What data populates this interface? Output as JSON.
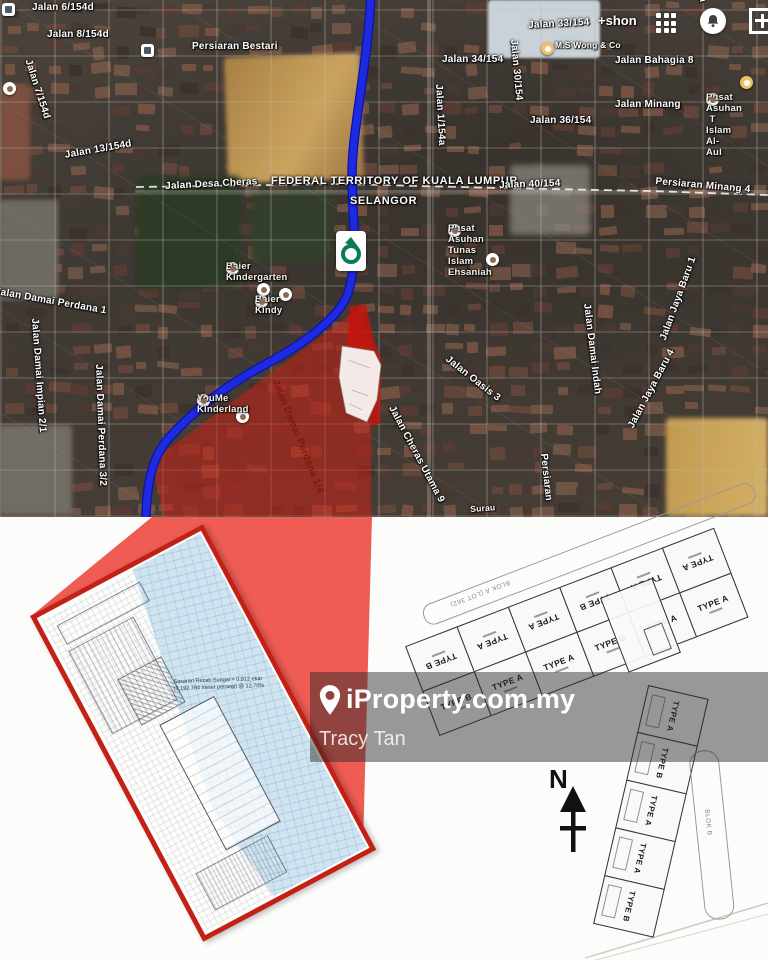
{
  "map": {
    "account_label": "+shon",
    "boundary_label": "FEDERAL TERRITORY OF KUALA LUMPUR",
    "state_label": "SELANGOR",
    "labels": [
      {
        "n": "jalan-6-154d",
        "t": "Jalan 6/154d",
        "x": 32,
        "y": 2,
        "r": 0
      },
      {
        "n": "jalan-8-154d",
        "t": "Jalan 8/154d",
        "x": 47,
        "y": 29,
        "r": 0
      },
      {
        "n": "jalan-7-154d",
        "t": "Jalan 7/154d",
        "x": 33,
        "y": 58,
        "r": 72
      },
      {
        "n": "jalan-13-154d",
        "t": "Jalan 13/154d",
        "x": 64,
        "y": 150,
        "r": -10
      },
      {
        "n": "persiaran-bestari",
        "t": "Persiaran Bestari",
        "x": 192,
        "y": 41,
        "r": 0
      },
      {
        "n": "jalan-desa-cheras",
        "t": "Jalan Desa Cheras",
        "x": 165,
        "y": 181,
        "r": -3
      },
      {
        "n": "federal-territory",
        "t": "FEDERAL TERRITORY OF KUALA LUMPUR",
        "x": 271,
        "y": 175,
        "r": 0,
        "s": "bold"
      },
      {
        "n": "selangor",
        "t": "SELANGOR",
        "x": 350,
        "y": 195,
        "r": 0,
        "s": "bold"
      },
      {
        "n": "jalan-33-154",
        "t": "Jalan 33/154",
        "x": 528,
        "y": 20,
        "r": -3
      },
      {
        "n": "jalan-34-154",
        "t": "Jalan 34/154",
        "x": 442,
        "y": 54,
        "r": 0
      },
      {
        "n": "jalan-30-154",
        "t": "Jalan 30/154",
        "x": 519,
        "y": 39,
        "r": 85
      },
      {
        "n": "jalan-bahagia-8",
        "t": "Jalan Bahagia 8",
        "x": 615,
        "y": 55,
        "r": 0
      },
      {
        "n": "jalan-bahagia-11",
        "t": "Jalan Bahagia 11",
        "x": 716,
        "y": -40,
        "r": 84
      },
      {
        "n": "jalan-minang",
        "t": "Jalan Minang",
        "x": 615,
        "y": 99,
        "r": 0
      },
      {
        "n": "jalan-36-154",
        "t": "Jalan 36/154",
        "x": 530,
        "y": 115,
        "r": 0
      },
      {
        "n": "jalan-1-154a",
        "t": "Jalan 1/154a",
        "x": 444,
        "y": 84,
        "r": 87
      },
      {
        "n": "jalan-40-154",
        "t": "Jalan 40/154",
        "x": 499,
        "y": 180,
        "r": -2
      },
      {
        "n": "persiaran-minang-4",
        "t": "Persiaran Minang 4",
        "x": 656,
        "y": 176,
        "r": 5
      },
      {
        "n": "ms-wong-co",
        "t": "M.S Wong & Co",
        "x": 555,
        "y": 41,
        "r": 0,
        "s": "poi-sm"
      },
      {
        "n": "pusat-asuhan-al-aul",
        "t": "Pusat Asuhan T\nIslam Al- Aul",
        "x": 706,
        "y": 93,
        "r": 0,
        "s": "poi"
      },
      {
        "n": "pusat-asuhan-tunas",
        "t": "Pusat Asuhan Tunas\nIslam Ehsaniah",
        "x": 448,
        "y": 224,
        "r": 0,
        "s": "poi"
      },
      {
        "n": "baier-kindergarten",
        "t": "Baier Kindergarten",
        "x": 226,
        "y": 262,
        "r": 0,
        "s": "poi"
      },
      {
        "n": "baier-kindy",
        "t": "Baier Kindy",
        "x": 255,
        "y": 295,
        "r": 0,
        "s": "poi"
      },
      {
        "n": "jalan-damai-perdana-1",
        "t": "Jalan Damai Perdana 1",
        "x": -4,
        "y": 286,
        "r": 10
      },
      {
        "n": "jalan-damai-impian-2-1",
        "t": "Jalan Damai Impian 2/1",
        "x": 40,
        "y": 318,
        "r": 86
      },
      {
        "n": "jalan-damai-perdana-3-2",
        "t": "Jalan Damai Perdana 3/2",
        "x": 104,
        "y": 364,
        "r": 88
      },
      {
        "n": "youme-kinderland",
        "t": "YouMe Kinderland",
        "x": 197,
        "y": 394,
        "r": 0,
        "s": "poi"
      },
      {
        "n": "jalan-damai-perdana-1-4",
        "t": "Jalan Damai Perdana 1/4",
        "x": 280,
        "y": 378,
        "r": 68,
        "s": "red"
      },
      {
        "n": "jalan-oasis-3",
        "t": "Jalan Oasis 3",
        "x": 450,
        "y": 354,
        "r": 38
      },
      {
        "n": "jalan-cheras-utama-9",
        "t": "Jalan Cheras Utama 9",
        "x": 396,
        "y": 404,
        "r": 62
      },
      {
        "n": "jalan-damai-indah",
        "t": "Jalan Damai Indah",
        "x": 592,
        "y": 303,
        "r": 83
      },
      {
        "n": "jalan-jaya-baru-4",
        "t": "Jalan Jaya Baru 4",
        "x": 626,
        "y": 425,
        "r": -62
      },
      {
        "n": "jalan-jaya-baru-1",
        "t": "Jalan Jaya Baru 1",
        "x": 658,
        "y": 338,
        "r": -70
      },
      {
        "n": "persiaran",
        "t": "Persiaran",
        "x": 549,
        "y": 453,
        "r": 84
      },
      {
        "n": "surau",
        "t": "Surau",
        "x": 470,
        "y": 505,
        "r": -4,
        "s": "poi-sm"
      }
    ],
    "poi_markers": [
      {
        "x": 257,
        "y": 283
      },
      {
        "x": 279,
        "y": 288
      },
      {
        "x": 236,
        "y": 410
      },
      {
        "x": 486,
        "y": 253
      },
      {
        "x": 541,
        "y": 42,
        "tan": 1
      },
      {
        "x": 740,
        "y": 76,
        "tan": 1
      },
      {
        "x": 3,
        "y": 82
      }
    ],
    "colors": {
      "overlay_red": "#d81c10",
      "route_blue": "#1e2ae0",
      "wedge_red": "#ee5c54",
      "inset_border": "#c42116",
      "water_blue": "#cfe4f0"
    }
  },
  "watermark": {
    "brand": "iProperty.com.my",
    "agent": "Tracy Tan"
  },
  "inset": {
    "note_line1": "Sasaran Rezab Sungai = 0.912 ekar",
    "note_line2": "(3,192.784 meter persegi) @ 12.70%"
  },
  "blocks": {
    "north_label": "N",
    "block_a": {
      "road_label": "BLOK A (LOT 362)",
      "top_row": [
        "TYPE B",
        "TYPE A",
        "TYPE A",
        "TYPE B",
        "TYPE A",
        "TYPE A"
      ],
      "bottom_row": [
        "TYPE B",
        "TYPE A",
        "TYPE A",
        "TYPE B",
        "TYPE A",
        "TYPE A"
      ]
    },
    "block_b": {
      "road_label": "BLOK B",
      "units": [
        "TYPE A",
        "TYPE B",
        "TYPE A",
        "TYPE A",
        "TYPE B"
      ]
    }
  }
}
